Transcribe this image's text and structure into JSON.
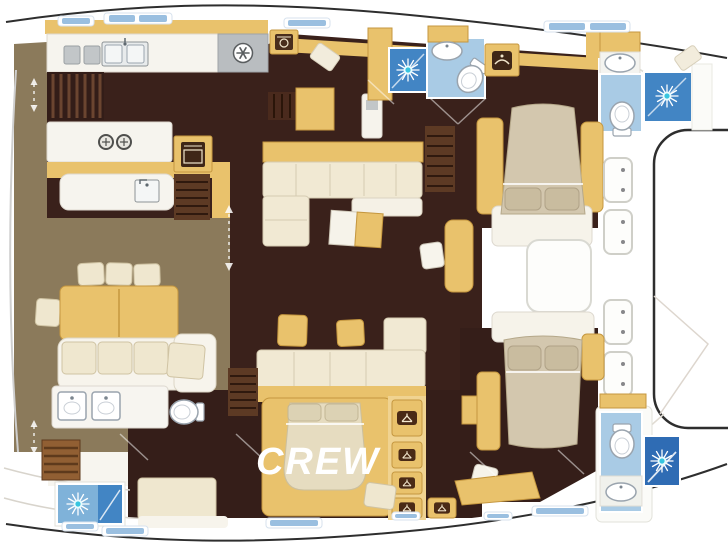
{
  "labels": {
    "crew": "CREW"
  },
  "rooms": [
    "aft-cockpit",
    "galley",
    "saloon",
    "crew-cabin",
    "forward-cabin-upper",
    "forward-cabin-lower",
    "bathroom-upper-aft",
    "bathroom-upper-forward",
    "bathroom-lower-aft",
    "bathroom-lower-forward",
    "foredeck",
    "bow-platform"
  ],
  "icons": [
    "sun-shower-icon",
    "snowflake-fridge-icon",
    "hanger-wardrobe-icon",
    "burner-stove-icon",
    "oven-icon",
    "washer-icon",
    "hatch-icon",
    "sink-icon",
    "toilet-icon"
  ],
  "colors": {
    "background": "#ffffff",
    "deck_olive": "#8b7a5b",
    "floor_dark": "#3a211b",
    "wall_yellow": "#e9c26c",
    "wall_yellow_light": "#f0d391",
    "sofa_cream": "#f1e9d3",
    "bed_tan": "#d3c7ae",
    "bath_floor_blue": "#a9cbe5",
    "shower_blue": "#4285c4",
    "shower_blue_dark": "#2f6cb4",
    "appliance_gray": "#b9bdc0",
    "hull_outline": "#2e2e2e",
    "window_label_blue": "#8fb8dd",
    "stair_wood": "#5d3a24",
    "ladder_wood": "#915f33"
  }
}
